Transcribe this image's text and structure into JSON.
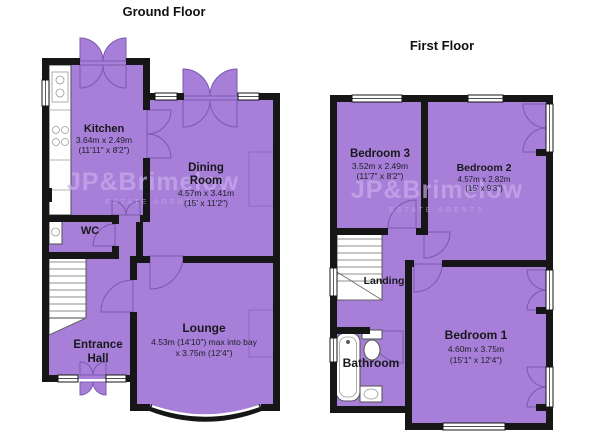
{
  "ground_floor": {
    "title": "Ground Floor",
    "rooms": {
      "kitchen": {
        "name": "Kitchen",
        "metric": "3.64m x 2.49m",
        "imperial": "(11'11\" x 8'2\")"
      },
      "dining_room": {
        "name_line1": "Dining",
        "name_line2": "Room",
        "metric": "4.57m x 3.41m",
        "imperial": "(15' x 11'2\")"
      },
      "wc": {
        "name": "WC"
      },
      "lounge": {
        "name": "Lounge",
        "metric": "4.53m (14'10\") max into bay",
        "imperial": "x 3.75m (12'4\")"
      },
      "entrance_hall": {
        "name_line1": "Entrance",
        "name_line2": "Hall"
      }
    }
  },
  "first_floor": {
    "title": "First Floor",
    "rooms": {
      "bedroom3": {
        "name": "Bedroom 3",
        "metric": "3.52m x 2.49m",
        "imperial": "(11'7\" x 8'2\")"
      },
      "bedroom2": {
        "name": "Bedroom 2",
        "metric": "4.57m x 2.82m",
        "imperial": "(15' x 9'3\")"
      },
      "landing": {
        "name": "Landing"
      },
      "bathroom": {
        "name": "Bathroom"
      },
      "bedroom1": {
        "name": "Bedroom 1",
        "metric": "4.60m x 3.75m",
        "imperial": "(15'1\" x 12'4\")"
      }
    }
  },
  "watermark": {
    "name": "JP&Brimelow",
    "tagline": "ESTATE AGENTS"
  },
  "colors": {
    "floor_fill": "#a77fd8",
    "wall": "#161616",
    "watermark": "#c9aded",
    "background": "#ffffff"
  }
}
